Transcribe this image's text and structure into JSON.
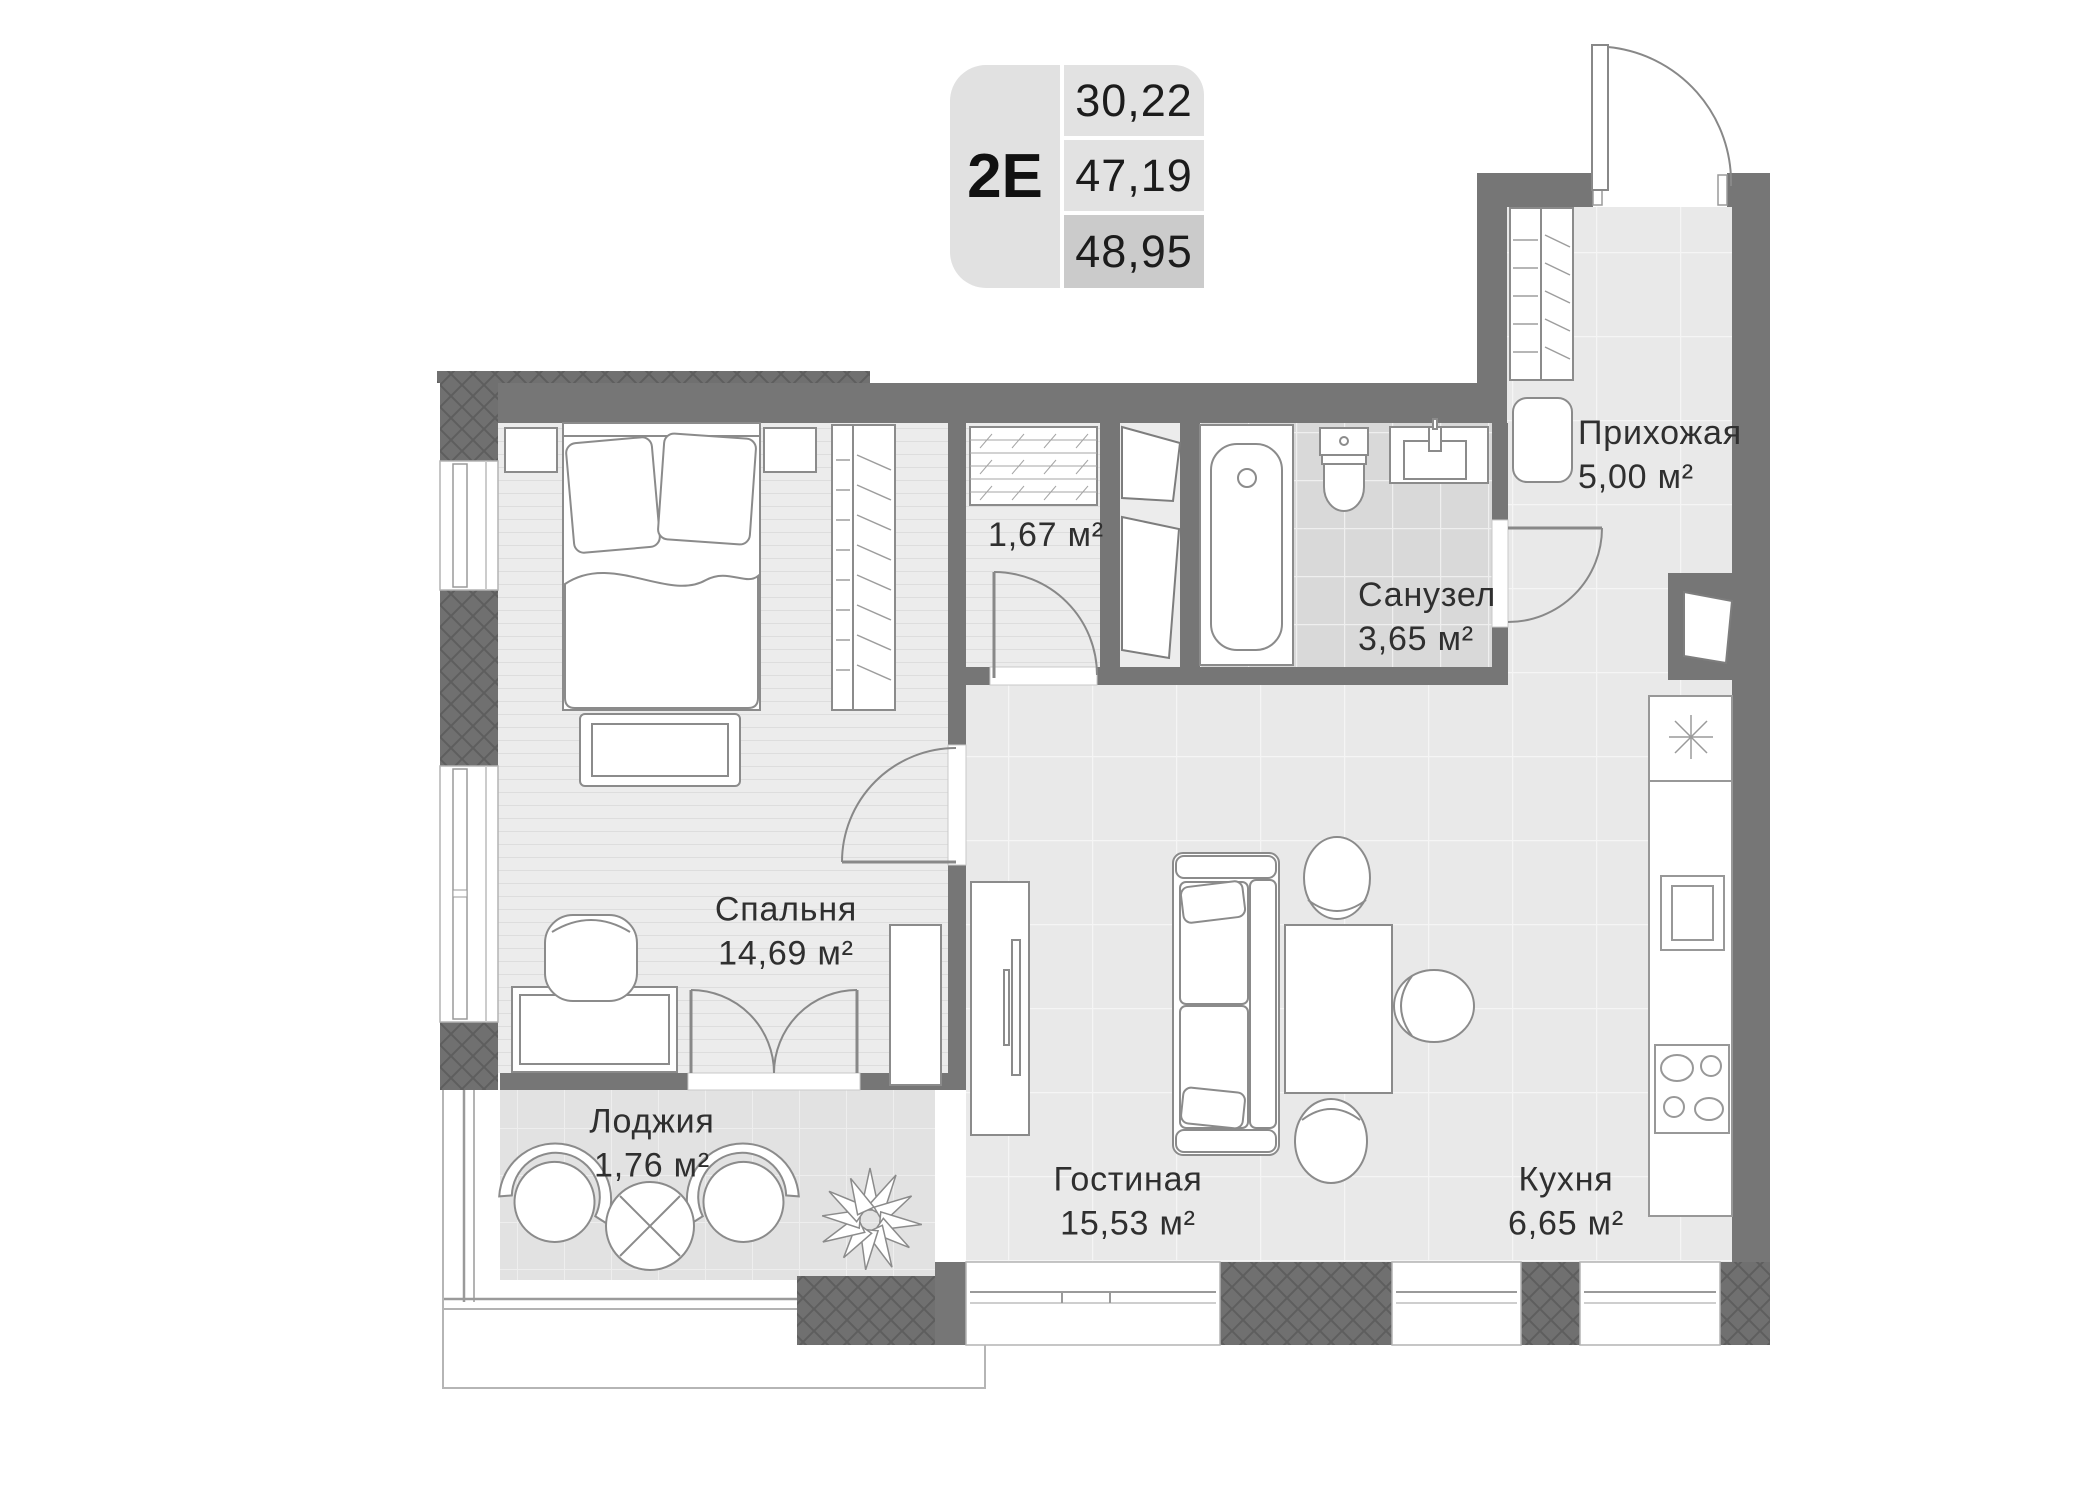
{
  "legend": {
    "unit_code": "2E",
    "areas": [
      "30,22",
      "47,19",
      "48,95"
    ]
  },
  "rooms": {
    "hallway": {
      "name": "Прихожая",
      "area": "5,00 м²"
    },
    "bathroom": {
      "name": "Санузел",
      "area": "3,65 м²"
    },
    "closet": {
      "area": "1,67 м²"
    },
    "bedroom": {
      "name": "Спальня",
      "area": "14,69 м²"
    },
    "loggia": {
      "name": "Лоджия",
      "area": "1,76 м²"
    },
    "living_room": {
      "name": "Гостиная",
      "area": "15,53 м²"
    },
    "kitchen": {
      "name": "Кухня",
      "area": "6,65 м²"
    }
  },
  "colors": {
    "wall": "#767676",
    "wall_hatch": "#5e5e5e",
    "floor_light": "#e9e9e9",
    "floor_bedroom": "#ececec",
    "floor_bath": "#d9d9d9",
    "floor_loggia": "#e2e2e2",
    "legend_cell": "#e1e1e1",
    "legend_highlight": "#cbcbcb",
    "text": "#2f2f2f"
  }
}
